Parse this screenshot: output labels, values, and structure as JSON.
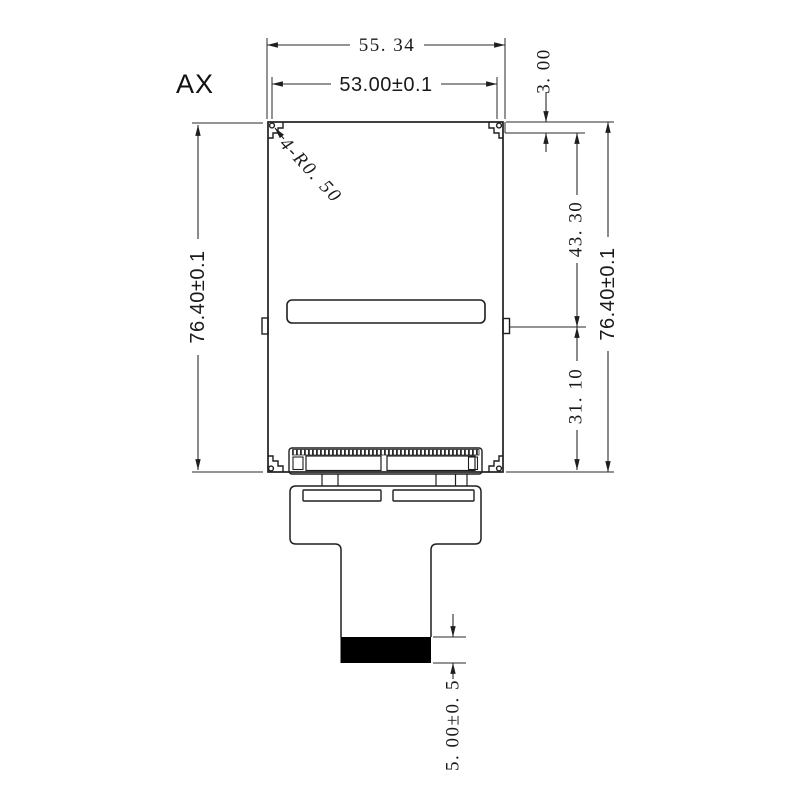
{
  "drawing": {
    "view_label": "AX",
    "corner_note": "4-R0. 50",
    "dims": {
      "overall_width": "55. 34",
      "active_width": "53.00±0.1",
      "height_left": "76.40±0.1",
      "height_right": "76.40±0.1",
      "top_step": "3. 00",
      "upper_section": "43. 30",
      "lower_section": "31. 10",
      "connector_tail": "5. 00±0. 5"
    },
    "colors": {
      "line": "#1f1f1f",
      "stiffener_fill": "#000000",
      "background": "#ffffff"
    }
  }
}
